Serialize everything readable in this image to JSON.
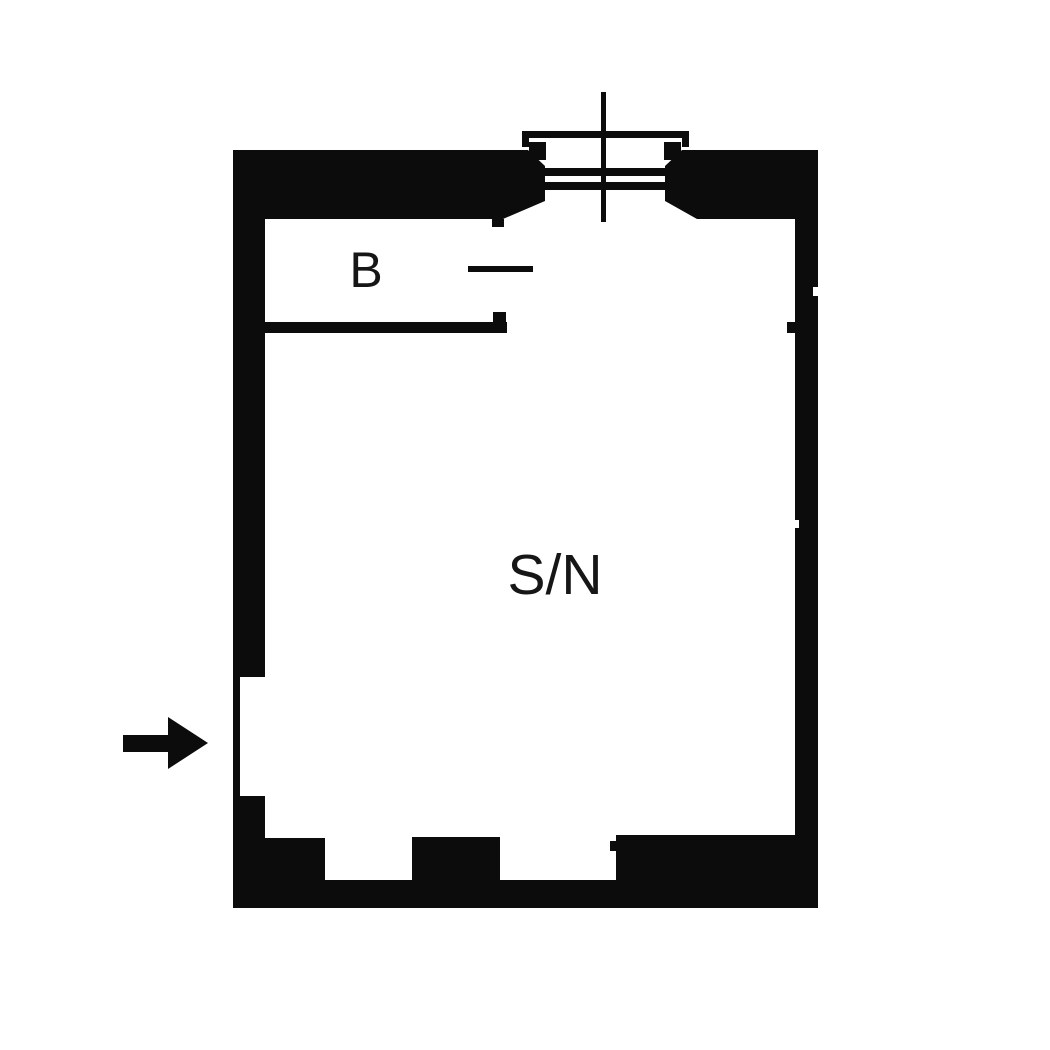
{
  "document": {
    "type": "floor plan",
    "background_color": "#ffffff",
    "wall_color": "#0c0c0c",
    "label_color": "#161616"
  },
  "rooms": {
    "main": {
      "label": "S/N"
    },
    "b": {
      "label": "B"
    }
  },
  "symbols": {
    "entrance_arrow": "entrance-arrow",
    "window": "window-symbol",
    "door_opening": "door-opening-line"
  }
}
